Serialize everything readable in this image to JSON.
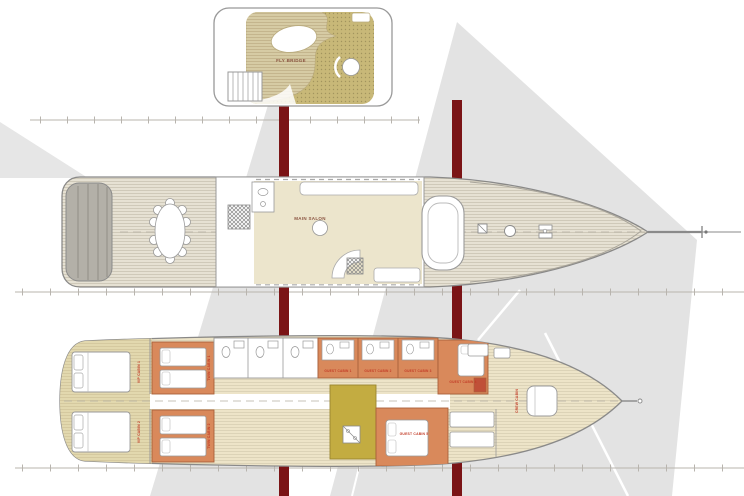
{
  "drawing": {
    "type": "sailing-yacht-deck-plans",
    "views": [
      "fly bridge deck",
      "main deck",
      "lower deck"
    ]
  },
  "decks": {
    "fly_bridge": {
      "label": "FLY BRIDGE"
    },
    "main_deck": {
      "salon_label": "MAIN SALON"
    },
    "lower_deck": {
      "guest_cabins": [
        {
          "label": "GUEST CABIN 1"
        },
        {
          "label": "GUEST CABIN 2"
        },
        {
          "label": "GUEST CABIN 3"
        },
        {
          "label": "GUEST CABIN 4"
        },
        {
          "label": "GUEST CABIN 5"
        }
      ],
      "vip_cabin_1_label": "VIP CABIN 1",
      "vip_cabin_2_label": "VIP CABIN 2",
      "twin_cabin_1_label": "TWIN CABIN 1",
      "twin_cabin_2_label": "TWIN CABIN 2",
      "crew_cabin_label": "CREW CABIN"
    }
  },
  "colors": {
    "mast_red": "#7b1416",
    "sail_gray": "#e3e3e3",
    "cabin_orange": "#d9895b",
    "galley_olive": "#c3ac41",
    "deck_wood_tan": "#d6cba4",
    "sunpad_khaki": "#c8b878",
    "floor_cream": "#ede4c8",
    "label_red": "#c23b26",
    "hull_line_gray": "#8a8a8a"
  }
}
